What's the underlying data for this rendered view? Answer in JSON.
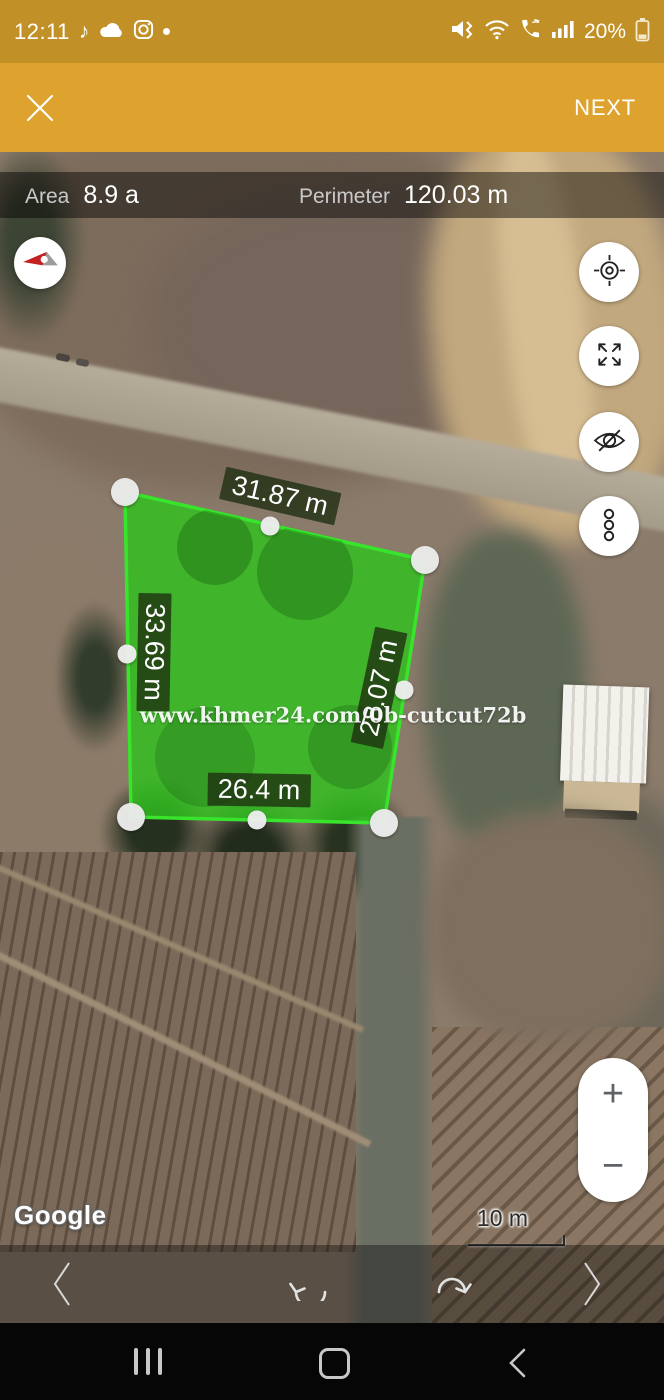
{
  "status_bar": {
    "time": "12:11",
    "battery_percent": "20%",
    "tiktok_glyph": "♪",
    "notification_dot": "•",
    "icons": [
      "tiktok-icon",
      "cloud-icon",
      "instagram-icon",
      "notification-dot",
      "mute-vibrate-icon",
      "wifi-icon",
      "wifi-calling-icon",
      "signal-icon",
      "battery-icon"
    ]
  },
  "header": {
    "next_label": "NEXT",
    "close_icon": "close-icon"
  },
  "measure_bar": {
    "area_label": "Area",
    "area_value": "8.9 a",
    "perimeter_label": "Perimeter",
    "perimeter_value": "120.03 m"
  },
  "map": {
    "edge_labels": [
      {
        "edge": "top",
        "text": "31.87 m"
      },
      {
        "edge": "left",
        "text": "33.69 m"
      },
      {
        "edge": "right",
        "text": "28.07 m"
      },
      {
        "edge": "bottom",
        "text": "26.4 m"
      }
    ],
    "watermark": "www.khmer24.com/0b-cutcut72b",
    "attribution": "Google",
    "scale_label": "10 m",
    "zoom_in_glyph": "+",
    "zoom_out_glyph": "−",
    "side_buttons": [
      "my-location",
      "fullscreen",
      "hide-labels",
      "more-options"
    ]
  },
  "colors": {
    "status_bar_bg": "#c19127",
    "header_bg": "#dda32e",
    "polygon_fill": "#2fc21e",
    "polygon_stroke": "#38e52c",
    "dim_label_bg": "rgba(30,46,16,0.78)",
    "measure_bar_bg": "rgba(0,0,0,0.45)"
  }
}
